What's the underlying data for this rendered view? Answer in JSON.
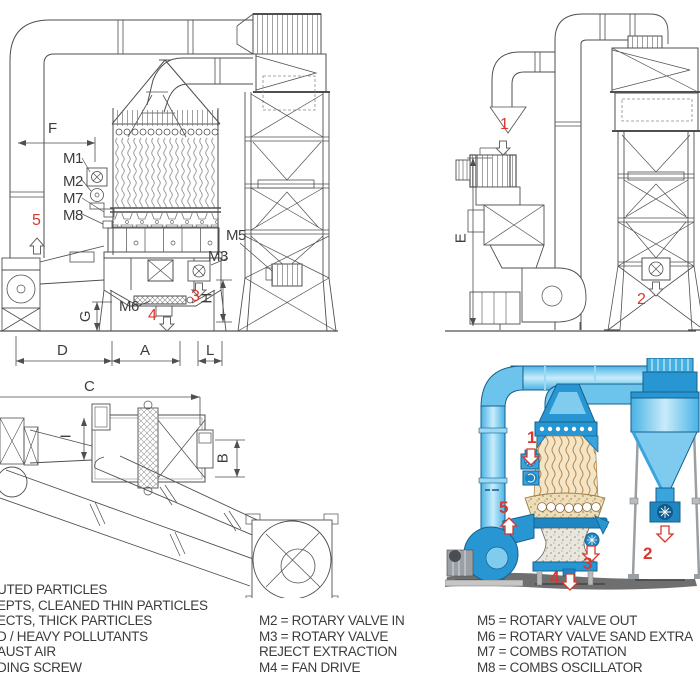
{
  "colors": {
    "accent_red": "#d8382d",
    "line": "#4f4f4f",
    "blue_main": "#2796d3",
    "blue_mid": "#49b2e4",
    "blue_light": "#c9ecfb",
    "tan": "#f3e5c5",
    "ground": "#6f6f6f"
  },
  "front_view": {
    "dims": {
      "f": "F",
      "d": "D",
      "a": "A",
      "l": "L",
      "g": "G",
      "h": "H"
    },
    "motors": {
      "m1": "M1",
      "m2": "M2",
      "m7": "M7",
      "m8": "M8",
      "m5": "M5",
      "m3": "M3",
      "m6": "M6"
    },
    "flows": {
      "n3": "3",
      "n4": "4",
      "n5": "5"
    }
  },
  "side_view": {
    "dims": {
      "e": "E"
    },
    "flows": {
      "n1": "1",
      "n2": "2"
    }
  },
  "plan_view": {
    "dims": {
      "c": "C",
      "b": "B",
      "i": "I"
    }
  },
  "illustration": {
    "flows": {
      "n1": "1",
      "n2": "2",
      "n3": "3",
      "n4": "4",
      "n5": "5"
    }
  },
  "legend": {
    "left": [
      "UTED PARTICLES",
      "EPTS, CLEANED THIN PARTICLES",
      "ECTS, THICK PARTICLES",
      "D / HEAVY POLLUTANTS",
      "AUST AIR",
      "DING SCREW"
    ],
    "middle": [
      "M2 = ROTARY VALVE IN",
      "M3 = ROTARY VALVE",
      "REJECT EXTRACTION",
      "M4 = FAN DRIVE"
    ],
    "right": [
      "M5 = ROTARY VALVE OUT",
      "M6 = ROTARY VALVE SAND EXTRA",
      "M7 = COMBS ROTATION",
      "M8 = COMBS OSCILLATOR"
    ]
  }
}
